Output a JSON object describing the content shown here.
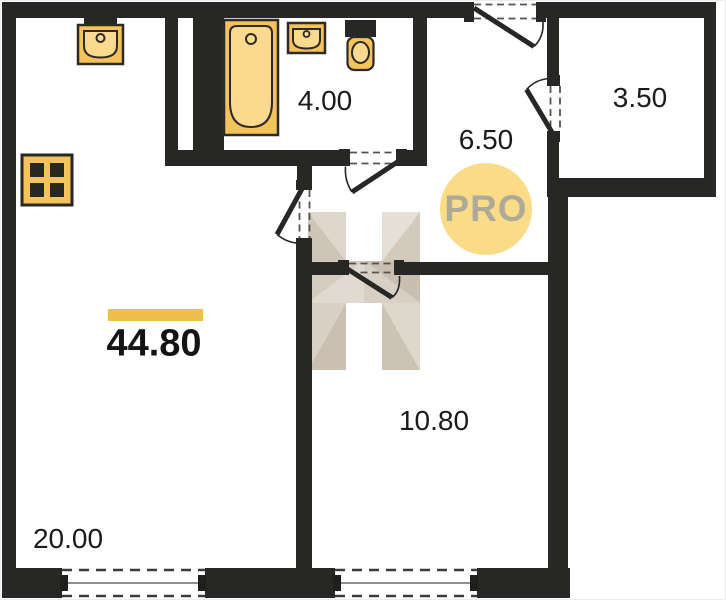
{
  "floor_plan": {
    "badge": {
      "text": "PRO"
    },
    "total_area": {
      "value": "44.80",
      "highlighted": true,
      "accent_bar_color": "#F0BE4E"
    },
    "rooms": [
      {
        "name": "living-room",
        "area": "20.00"
      },
      {
        "name": "bedroom",
        "area": "10.80"
      },
      {
        "name": "hallway",
        "area": "6.50"
      },
      {
        "name": "bathroom",
        "area": "4.00"
      },
      {
        "name": "balcony",
        "area": "3.50"
      }
    ],
    "fixtures": [
      "kitchen-sink",
      "stove",
      "bathtub",
      "washbasin",
      "toilet"
    ],
    "colors": {
      "wall": "#272726",
      "fixture_fill": "#F4C35B",
      "fixture_fill_light": "#FBD98F",
      "badge_fill": "#FADC88",
      "badge_text": "#A3A29B",
      "watermark_beige": "#D5CCBE"
    }
  }
}
